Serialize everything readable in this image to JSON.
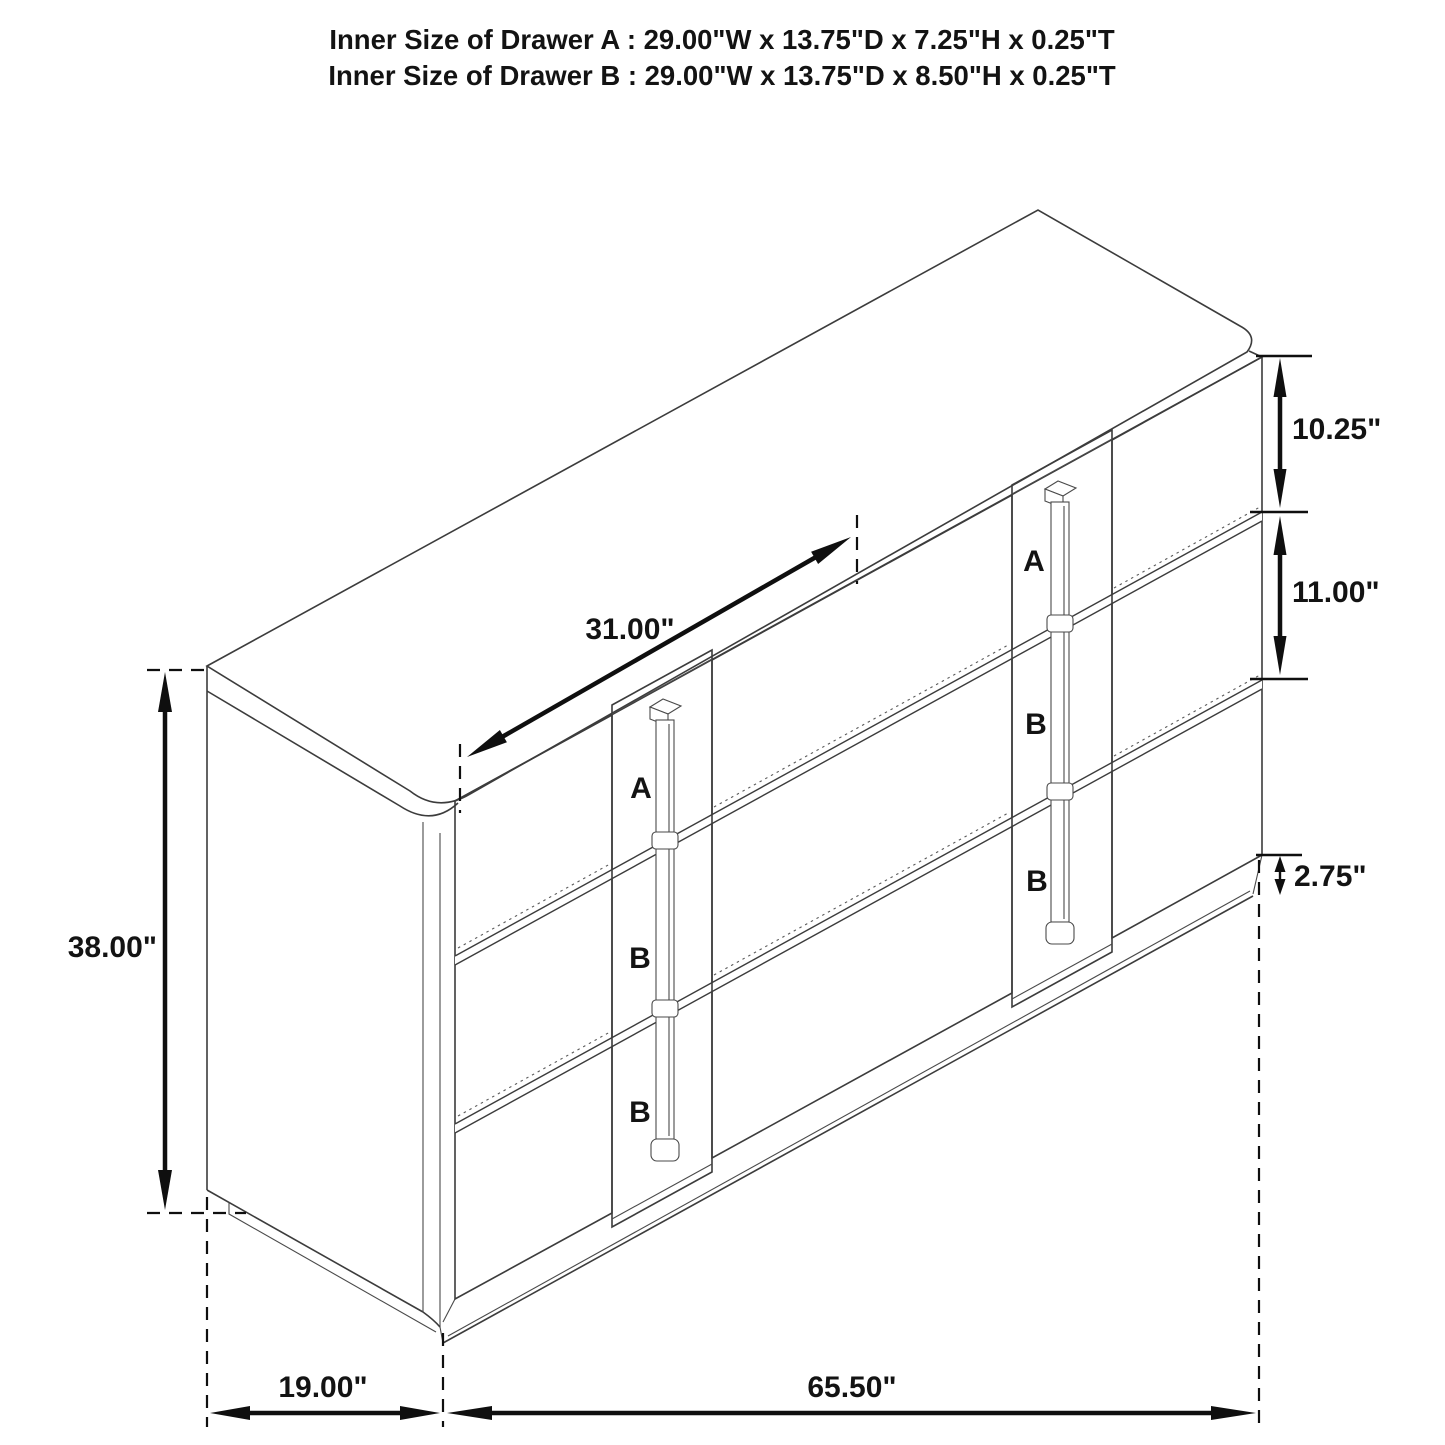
{
  "title": {
    "line1": "Inner Size of Drawer A : 29.00\"W x 13.75\"D x 7.25\"H x 0.25\"T",
    "line2": "Inner Size of Drawer B : 29.00\"W x 13.75\"D x 8.50\"H x 0.25\"T"
  },
  "dimensions": {
    "drawer_front_width": "31.00\"",
    "top_drawer_height": "10.25\"",
    "middle_drawer_height": "11.00\"",
    "base_height": "2.75\"",
    "overall_height": "38.00\"",
    "overall_depth": "19.00\"",
    "overall_width": "65.50\""
  },
  "drawer_labels": {
    "left_column": [
      "A",
      "B",
      "B"
    ],
    "right_column": [
      "A",
      "B",
      "B"
    ]
  },
  "colors": {
    "drawer_label_red": "#e2242b",
    "line_dark": "#3c3c3c",
    "dimension_black": "#0f0f0f",
    "background": "#ffffff"
  }
}
